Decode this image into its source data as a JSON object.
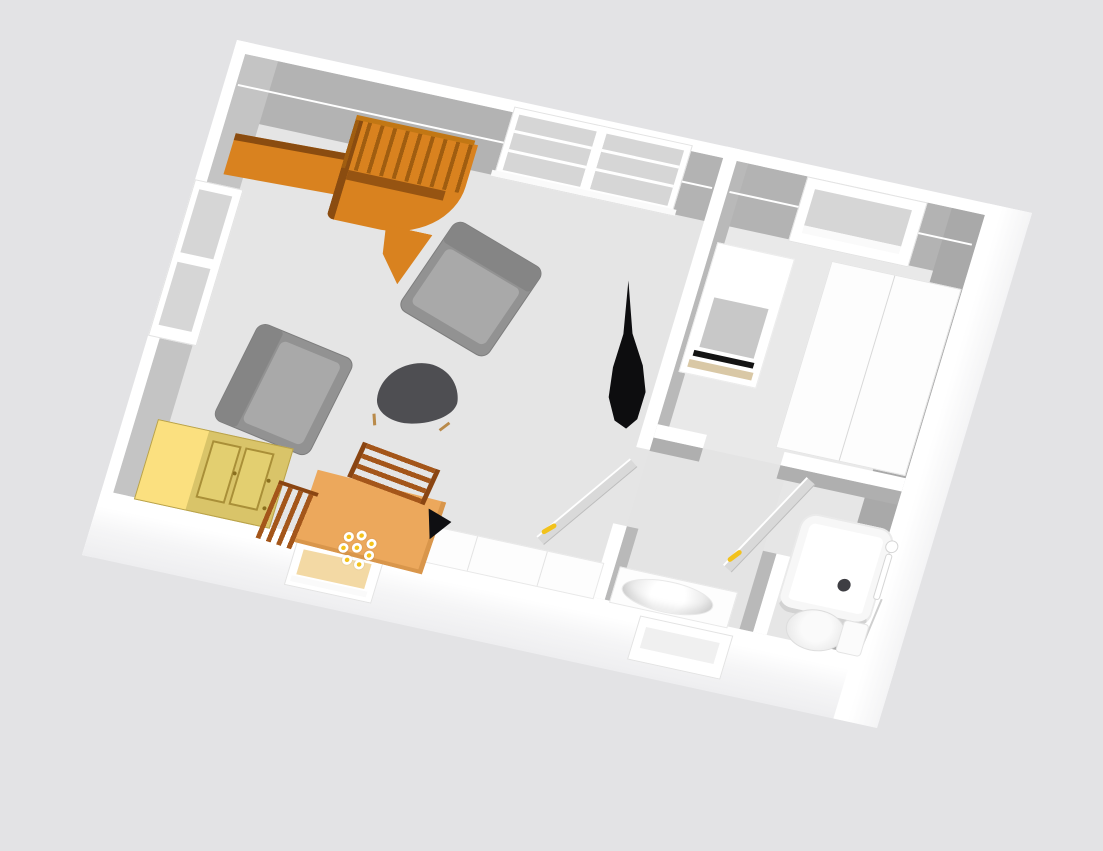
{
  "scene": {
    "kind": "3d-floorplan-render",
    "description": "Top-down oblique 3D render of a one-bedroom apartment, rotated clockwise, white walls with gray interior faces",
    "colors": {
      "background": "#e3e3e5",
      "wall_face": "#b3b3b3",
      "floor_living": "#e5e5e5",
      "floor_bedroom": "#e9e9e9",
      "floor_hall": "#e4e4e4",
      "floor_bath": "#e6e6e6",
      "wood_orange": "#d9821f",
      "wood_dark": "#8a4c10",
      "table_orange": "#eca85c",
      "chair_brown": "#a4561a",
      "cabinet_yellow": "#fbe07f",
      "cabinet_dark": "#d9c469",
      "upholstery": "#929292",
      "coffee_table": "#4e4e52",
      "door_handle": "#f2c21c",
      "plant_black": "#0d0d0f",
      "drain": "#3e3e43"
    },
    "rooms": [
      {
        "id": "living-room",
        "position": "left",
        "items": [
          "wooden staircase with railing",
          "double casement window",
          "side wall window",
          "gray armchair",
          "gray armchair",
          "dark tripod coffee table",
          "black floor plant",
          "yellow two-door cabinet",
          "orange dining table",
          "wooden dining chair",
          "wooden dining chair",
          "flower bouquet",
          "white sideboard counter",
          "small window in front wall"
        ]
      },
      {
        "id": "bedroom",
        "position": "top-right",
        "items": [
          "white desk with dark keyboard strip",
          "white double wardrobe",
          "recessed window"
        ]
      },
      {
        "id": "hallway",
        "position": "bottom-center",
        "items": [
          "washbasin vanity counter",
          "low window in front wall"
        ]
      },
      {
        "id": "bathroom",
        "position": "bottom-right",
        "items": [
          "square shower tray with drain",
          "wall shower column",
          "toilet with cistern"
        ]
      }
    ],
    "doors": [
      {
        "id": "living-room-door",
        "state": "open",
        "handle_color": "#f2c21c"
      },
      {
        "id": "bathroom-door",
        "state": "open",
        "handle_color": "#f2c21c"
      }
    ]
  }
}
